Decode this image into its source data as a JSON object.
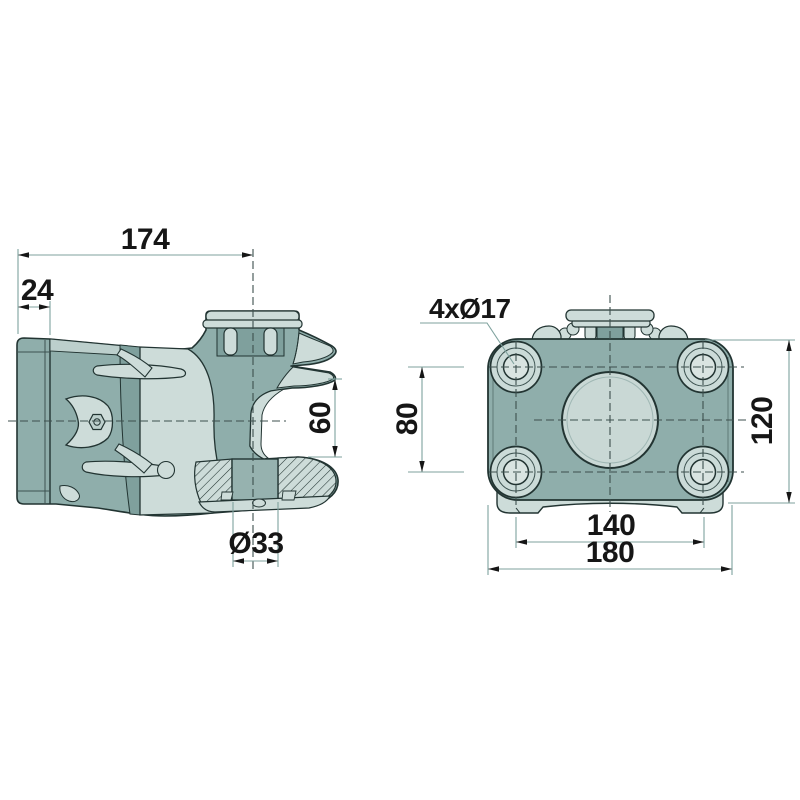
{
  "drawing": {
    "kind": "technical-drawing-two-views",
    "side_view": {
      "name": "side view",
      "dim_overall_length": "174",
      "dim_end_cap_depth": "24",
      "dim_jaw_gap": "60",
      "dim_bore": "Ø33"
    },
    "front_view": {
      "name": "front view",
      "dim_bolt_holes": "4xØ17",
      "dim_hole_spacing_vertical": "80",
      "dim_flange_height": "120",
      "dim_hole_spacing_horizontal": "140",
      "dim_flange_width": "180"
    },
    "colors": {
      "background": "#ffffff",
      "outline": "#223432",
      "fill_mid": "#8FAEAB",
      "fill_dark": "#7FA09D",
      "fill_light": "#CDDCD9",
      "fill_lighter": "#D9E4E1",
      "dimension_line": "#7FA29E",
      "center_line": "#3c4f4d",
      "text": "#161616"
    }
  }
}
